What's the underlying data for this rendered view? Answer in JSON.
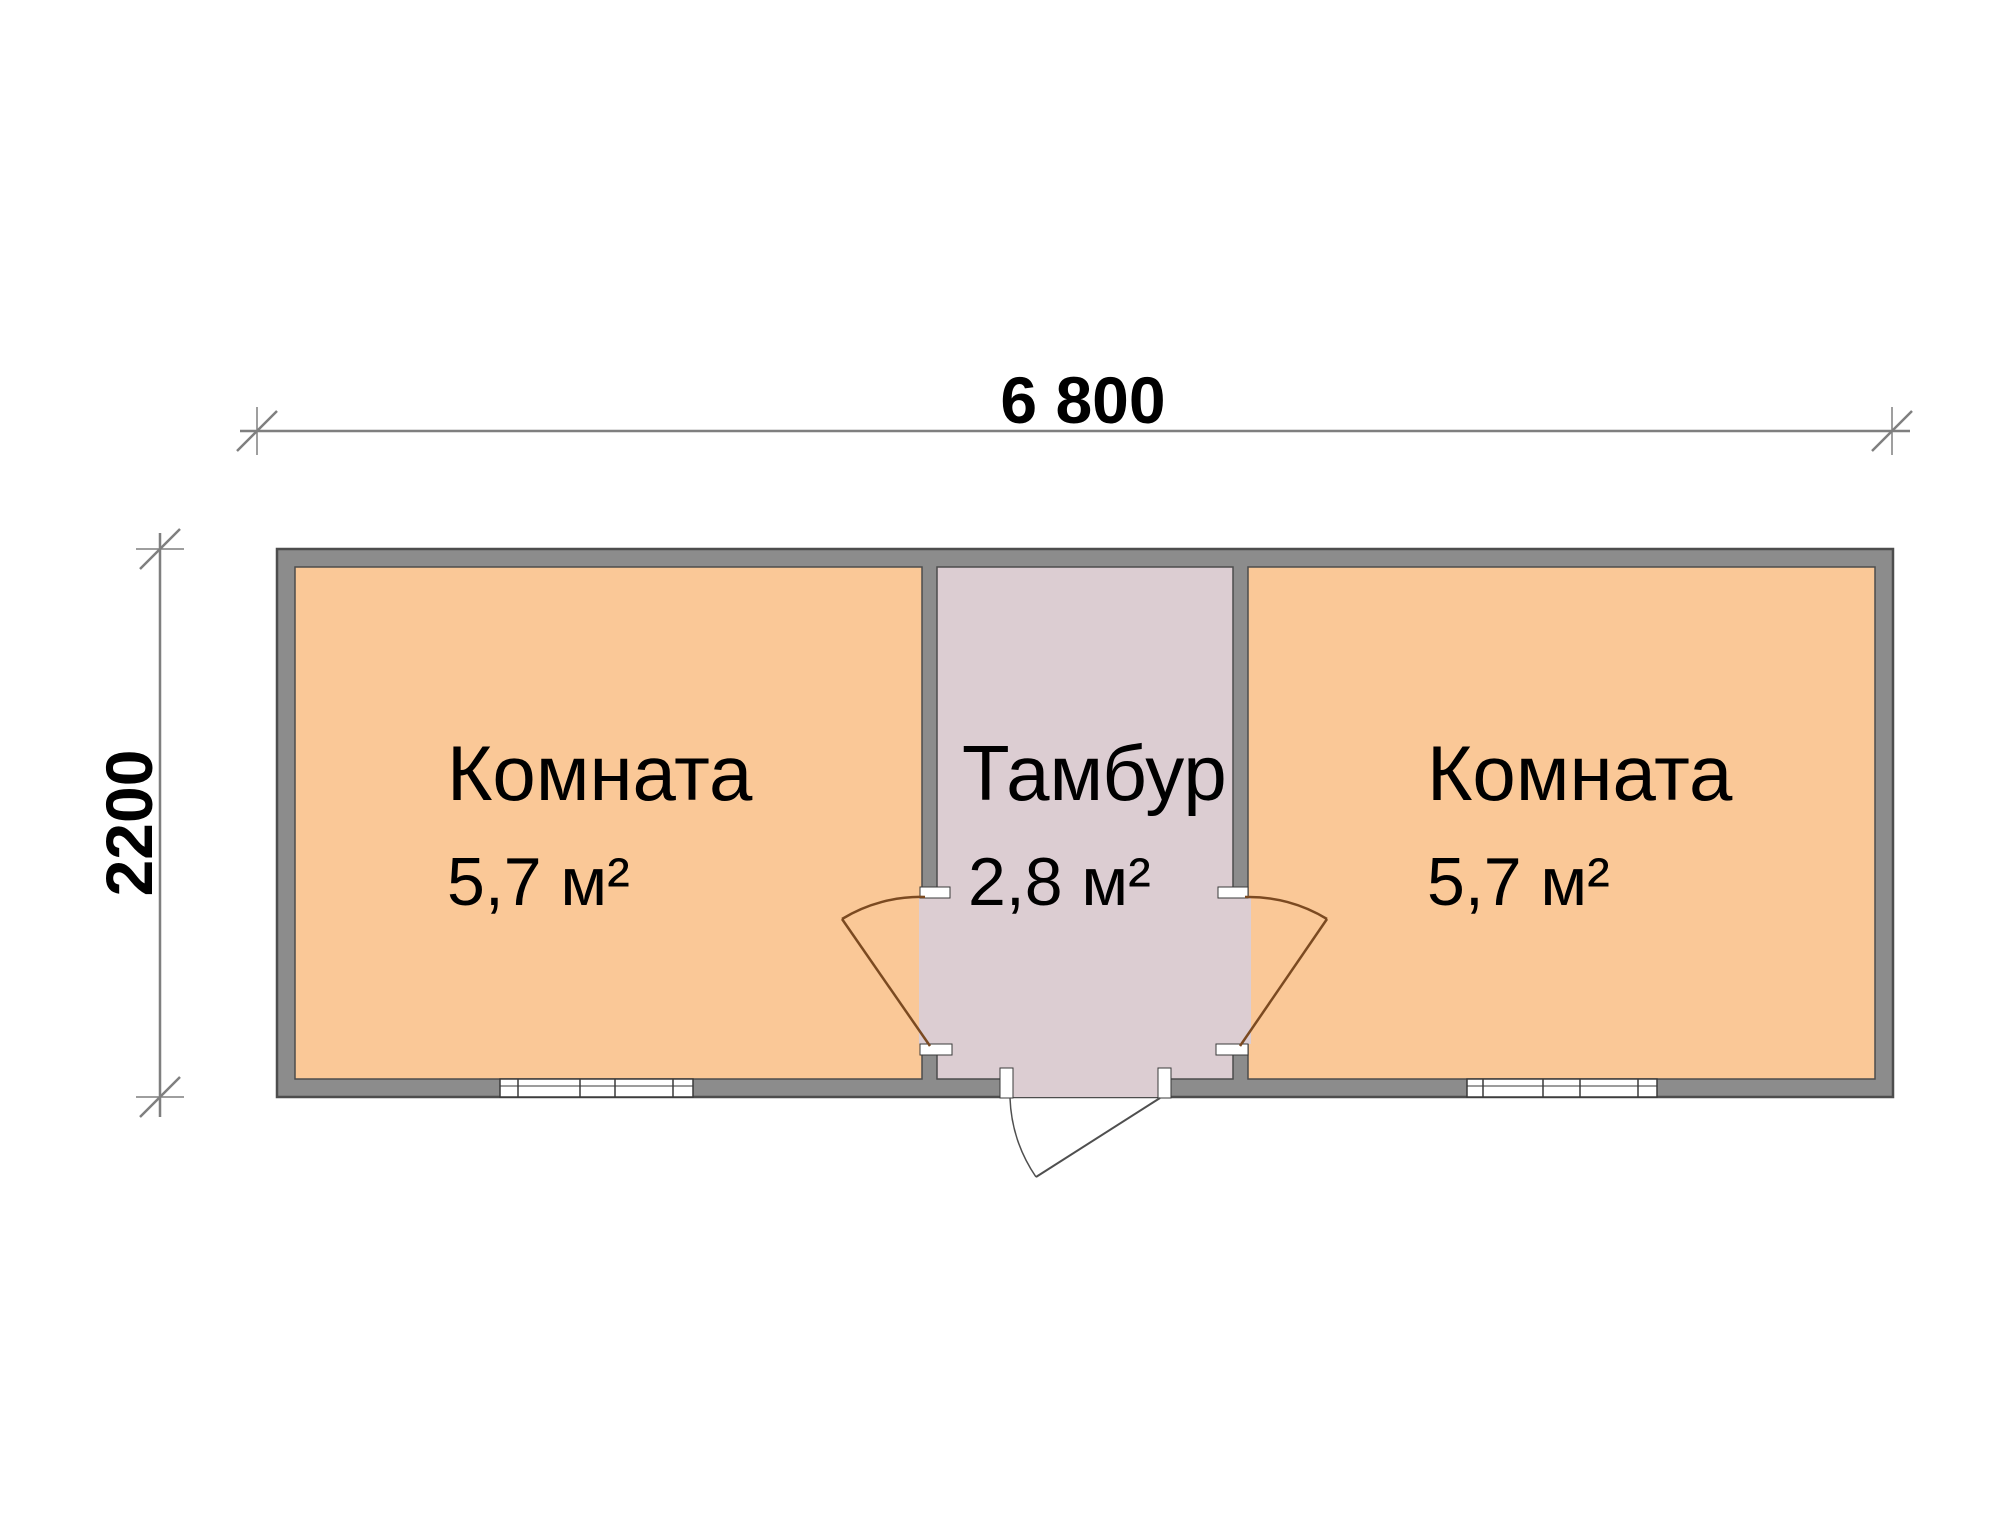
{
  "dimensions": {
    "width_label": "6 800",
    "height_label": "2200"
  },
  "rooms": {
    "left": {
      "name": "Комната",
      "area": "5,7 м²"
    },
    "tambour": {
      "name": "Тамбур",
      "area": "2,8 м²"
    },
    "right": {
      "name": "Комната",
      "area": "5,7 м²"
    }
  },
  "colors": {
    "room_fill": "#FAC897",
    "tambour_fill": "#DCCDD2",
    "wall_fill": "#8C8C8C",
    "wall_outline": "#4D4D4D",
    "interior_door": "#7B4A21",
    "entrance_door": "#4F4F4F",
    "dimension_line": "#7F7F7F",
    "text": "#000000",
    "window_fill": "#FFFFFF",
    "jamb_fill": "#FFFFFF"
  }
}
